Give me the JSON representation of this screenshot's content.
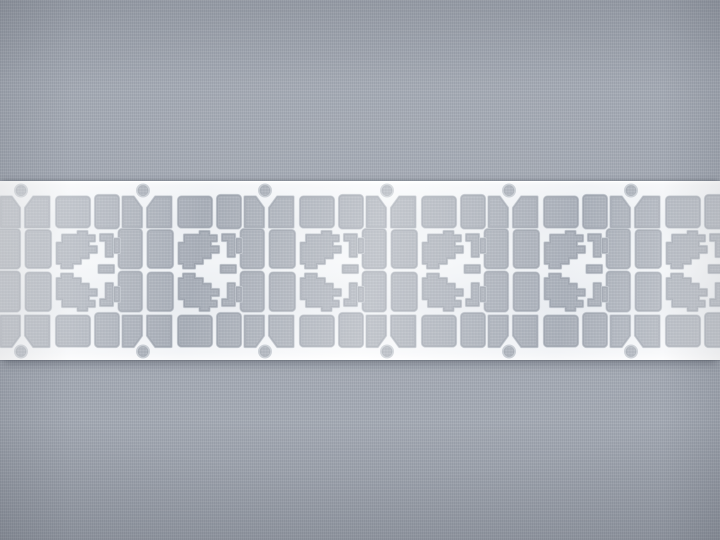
{
  "scene": {
    "kind": "photograph",
    "subject": "etched metal lead-frame strip (smart-card contact frames) lying on woven gray fabric",
    "width": 720,
    "height": 540
  },
  "colors": {
    "fabric_base": "#a3a9b3",
    "fabric_weave_light": "rgba(255,255,255,0.09)",
    "fabric_weave_dark": "rgba(58,64,78,0.08)",
    "fabric_in_cutout": "#9aa0ab",
    "cutout_weave_light": "rgba(255,255,255,0.10)",
    "cutout_weave_dark": "rgba(50,56,70,0.10)",
    "metal_white": "#f4f6f9",
    "etch_rim": "#bcc2ca",
    "cutout_edge_shadow": "#79818d",
    "strip_shadow": "rgba(52,58,70,0.42)"
  },
  "strip": {
    "top": 181,
    "height": 178,
    "unit_pitch": 122,
    "start_x": -101,
    "instances": 7,
    "full_units_visible": 5,
    "partial_units_visible": 2,
    "sprocket_holes_visible": 12
  },
  "unit": {
    "width": 122,
    "height": 178,
    "hole": {
      "cx": 0,
      "top_cy": 8.5,
      "bottom_cy": 169.5,
      "r": 5.2
    },
    "corner_chamfer": {
      "dx": 8,
      "dy": 11
    },
    "corner_cutouts": [
      {
        "x": 4.5,
        "y": 15,
        "w": 23.5,
        "h": 30,
        "corner": "tl"
      },
      {
        "x": 102,
        "y": 15,
        "w": 18.5,
        "h": 30,
        "corner": "tr"
      },
      {
        "x": 4.5,
        "y": 134,
        "w": 23.5,
        "h": 30.5,
        "corner": "bl"
      },
      {
        "x": 102,
        "y": 134,
        "w": 18.5,
        "h": 30.5,
        "corner": "br"
      }
    ],
    "rect_cutouts": [
      {
        "x": 35.5,
        "y": 15,
        "w": 33,
        "h": 30
      },
      {
        "x": 74.5,
        "y": 13.5,
        "w": 23,
        "h": 32.5
      },
      {
        "x": 5,
        "y": 48.5,
        "w": 24.5,
        "h": 37
      },
      {
        "x": 98,
        "y": 47.5,
        "w": 22.5,
        "h": 38.5
      },
      {
        "x": 5,
        "y": 91,
        "w": 24.5,
        "h": 37.5
      },
      {
        "x": 98,
        "y": 90,
        "w": 22.5,
        "h": 39
      },
      {
        "x": 35.5,
        "y": 134,
        "w": 33,
        "h": 30
      },
      {
        "x": 74.5,
        "y": 131.5,
        "w": 23,
        "h": 33
      }
    ],
    "center_cutouts": [
      "M36,61 L41.5,61 L41.5,53 L57,53 L57,49.5 L66,49.5 L66,53.5 L73.5,53.5 L73.5,59 L67.5,59 L67.5,64.5 L75.5,64.5 L75.5,70.5 L67.5,70.5 L67.5,76 L59.5,76 L59.5,81.5 L51.5,81.5 L51.5,86 L40.5,86 L40.5,81.5 L36,81.5 Z",
      "M36,96.5 L40.5,96.5 L40.5,92 L51.5,92 L51.5,96.5 L59.5,96.5 L59.5,102 L67.5,102 L67.5,107.5 L75.5,107.5 L75.5,113.5 L67.5,113.5 L67.5,119 L73.5,119 L73.5,124.5 L66,124.5 L66,128.5 L57,128.5 L57,124.5 L41.5,124.5 L41.5,117 L36,117 Z",
      "M79.5,52.5 L91.5,52.5 L91.5,74.5 L85,74.5 L85,58.5 L79.5,58.5 Z",
      "M93.5,57 L98,57 L98,70.5 L93.5,70.5 Z",
      "M78,83.5 L92.5,83.5 L92.5,90.5 L78,90.5 Z",
      "M85,101.5 L91.5,101.5 L91.5,123.5 L79.5,123.5 L79.5,117.5 L85,117.5 Z",
      "M93.5,105.5 L98,105.5 L98,119 L93.5,119 Z"
    ]
  }
}
